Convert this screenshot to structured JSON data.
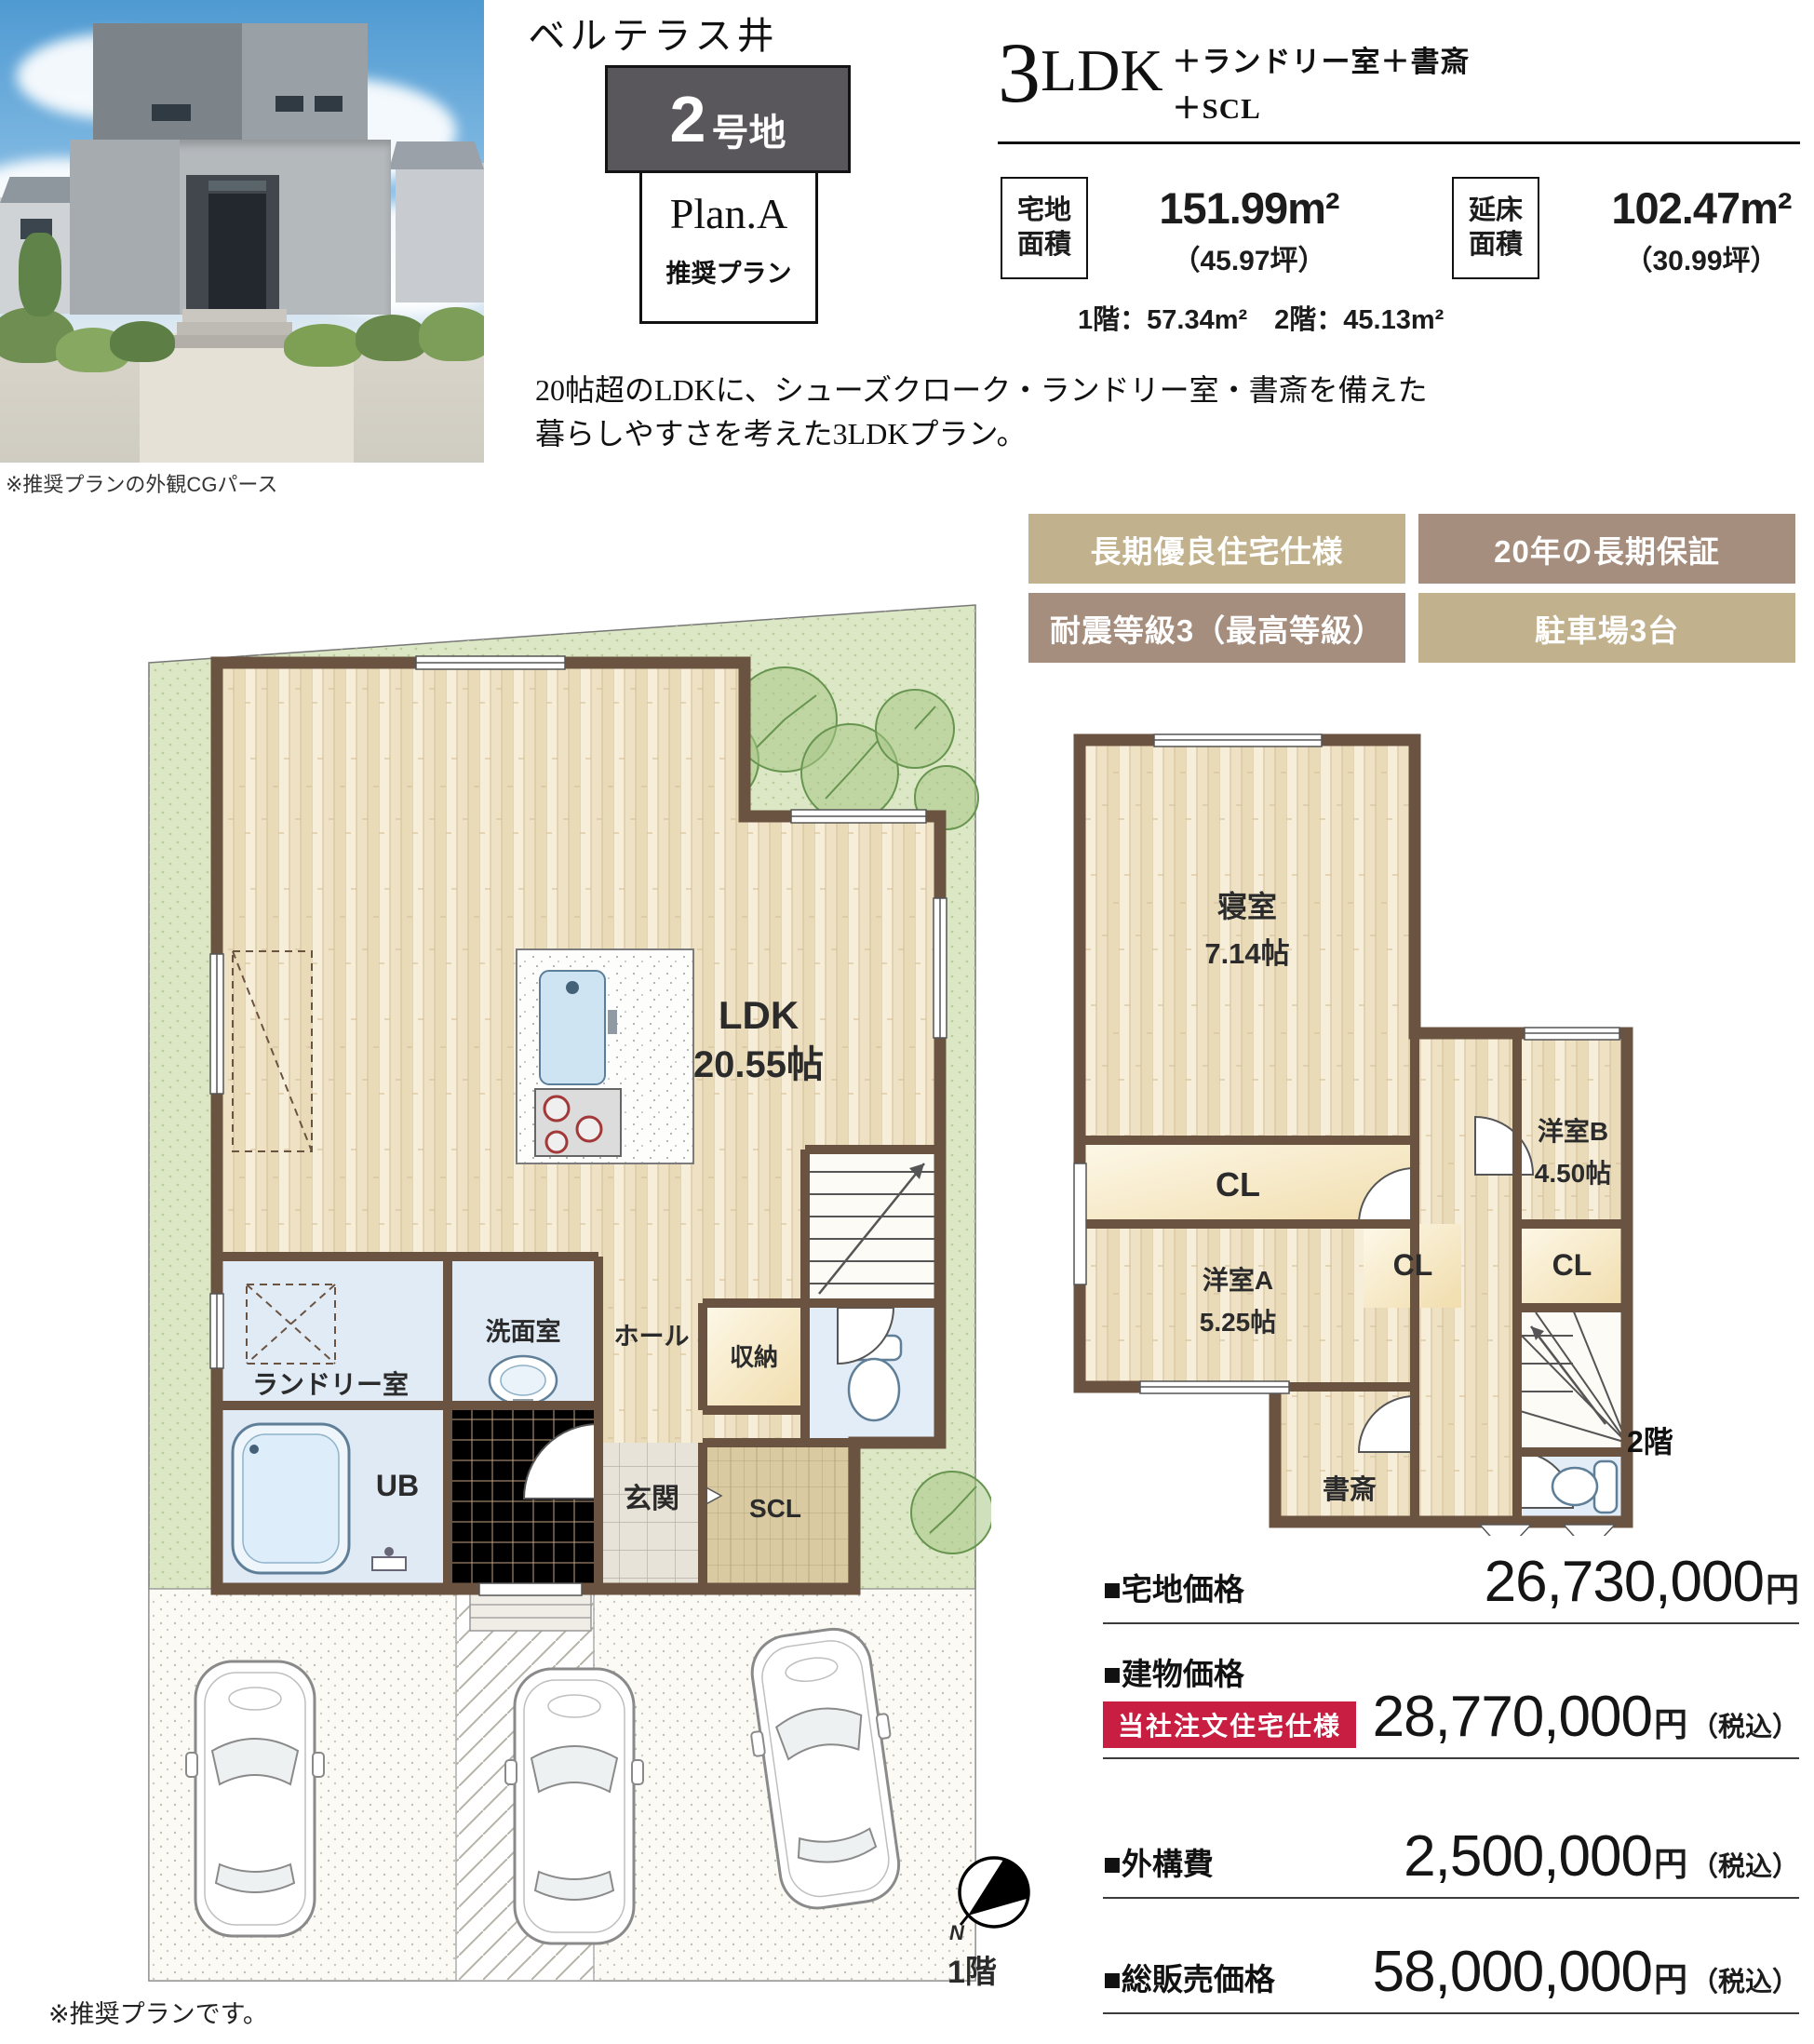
{
  "header": {
    "project_title": "ベルテラス井堀",
    "lot_badge": {
      "number": "2",
      "suffix": "号地"
    },
    "plan_name": "Plan.A",
    "plan_type": "推奨プラン",
    "photo_caption": "※推奨プランの外観CGパース",
    "layout": {
      "count": "3",
      "ldk": "LDK",
      "extras_line1": "＋ランドリー室＋書斎",
      "extras_line2": "＋SCL"
    }
  },
  "areas": {
    "land": {
      "label": "宅地面積",
      "value": "151.99m²",
      "tsubo": "（45.97坪）"
    },
    "floor": {
      "label": "延床面積",
      "value": "102.47m²",
      "tsubo": "（30.99坪）"
    },
    "floors_breakdown": "1階：57.34m²　2階：45.13m²"
  },
  "description": {
    "line1": "20帖超のLDKに、シューズクローク・ランドリー室・書斎を備えた",
    "line2": "暮らしやすさを考えた3LDKプラン。"
  },
  "features": [
    {
      "label": "長期優良住宅仕様",
      "color": "#c1b18c"
    },
    {
      "label": "20年の長期保証",
      "color": "#a68e7e"
    },
    {
      "label": "耐震等級3（最高等級）",
      "color": "#a68e7e"
    },
    {
      "label": "駐車場3台",
      "color": "#c1b18c"
    }
  ],
  "floor1": {
    "label": "1階",
    "compass_n": "N",
    "rooms": {
      "ldk": "LDK",
      "ldk_size": "20.55帖",
      "laundry": "ランドリー室",
      "washroom": "洗面室",
      "hall": "ホール",
      "storage": "収納",
      "bath": "UB",
      "entrance": "玄関",
      "shoes_closet": "SCL"
    }
  },
  "floor2": {
    "label": "2階",
    "rooms": {
      "bedroom": "寝室",
      "bedroom_size": "7.14帖",
      "closet1": "CL",
      "western_b": "洋室B",
      "western_b_size": "4.50帖",
      "western_a": "洋室A",
      "western_a_size": "5.25帖",
      "closet2": "CL",
      "closet3": "CL",
      "study": "書斎"
    }
  },
  "prices": {
    "rows": [
      {
        "label": "■宅地価格",
        "badge": "",
        "value": "26,730,000",
        "unit": "円",
        "note": ""
      },
      {
        "label": "■建物価格",
        "badge": "当社注文住宅仕様",
        "value": "28,770,000",
        "unit": "円",
        "note": "（税込）"
      },
      {
        "label": "■外構費",
        "badge": "",
        "value": "2,500,000",
        "unit": "円",
        "note": "（税込）"
      },
      {
        "label": "■総販売価格",
        "badge": "",
        "value": "58,000,000",
        "unit": "円",
        "note": "（税込）"
      }
    ]
  },
  "footnote": "※推奨プランです。",
  "colors": {
    "wall": "#6b5341",
    "wood": "#f4e8cf",
    "wet_floor": "#e0ebf6",
    "closet": "#f8eecb",
    "land": "#dce8c5",
    "badge_tan": "#c1b18c",
    "badge_brown": "#a68e7e",
    "price_badge_red": "#c81e41"
  }
}
